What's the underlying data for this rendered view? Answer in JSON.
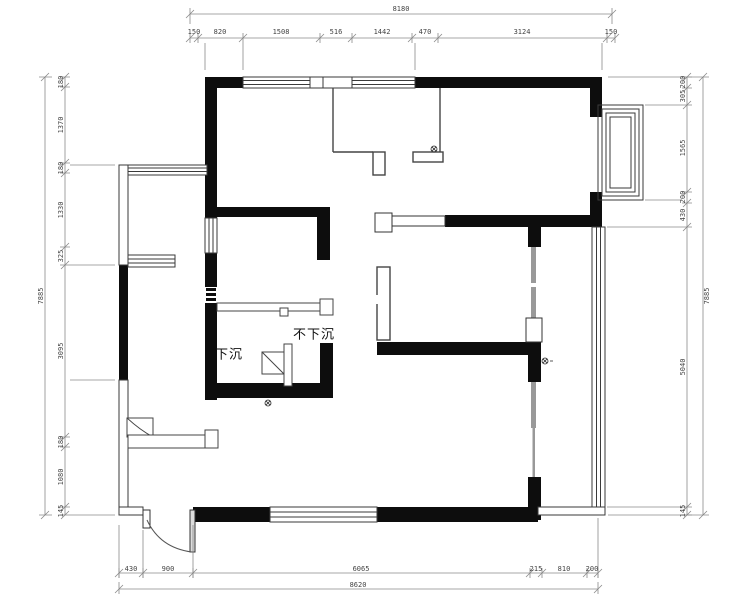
{
  "plan": {
    "labels": {
      "sunken": "下沉",
      "not_sunken": "不下沉"
    }
  },
  "dims": {
    "top": {
      "total": "8180",
      "segments": [
        "150",
        "820",
        "1508",
        "516",
        "1442",
        "470",
        "3124",
        "150"
      ]
    },
    "bottom": {
      "total": "8620",
      "segments": [
        "430",
        "900",
        "6065",
        "215",
        "810",
        "200"
      ]
    },
    "left": {
      "total": "7885",
      "segments": [
        "180",
        "1370",
        "180",
        "1330",
        "325",
        "3095",
        "180",
        "1080",
        "145"
      ]
    },
    "right": {
      "total": "7885",
      "segments": [
        "200",
        "305",
        "1565",
        "200",
        "430",
        "5040",
        "145"
      ]
    }
  }
}
